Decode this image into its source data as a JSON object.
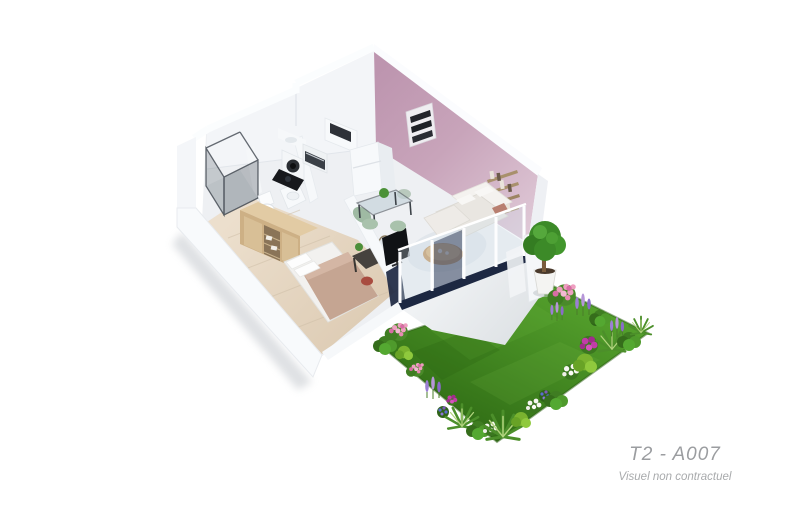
{
  "caption": {
    "unit_label": "T2 - A007",
    "disclaimer": "Visuel non contractuel"
  },
  "palette": {
    "pink_wall": "#c8a4ba",
    "pink_wall_dark": "#bd95af",
    "pink_wall_light": "#e0cad8",
    "wall": "#f7f9fb",
    "wall_shade": "#e9edf1",
    "floor": "#eef0f3",
    "floor_wood": "#e6dbc8",
    "grass_dark": "#2e6a14",
    "grass_light": "#54a02c",
    "terrace": "#eef0f2",
    "window_navy": "#1d2842",
    "wood_furniture": "#cdb085",
    "bed_blanket": "#c5a592",
    "sofa": "#ece9e4",
    "accent_cushion": "#b87f70",
    "chair_green": "#a9c2ac",
    "desk": "#46423e",
    "stool_red": "#a84c40",
    "coffee_table": "#c59a68",
    "foliage": "#3c8a28",
    "flower_pink": "#ee9fc0",
    "flower_magenta": "#c13da8",
    "flower_lavender": "#9c7fd4",
    "flower_white": "#f7f7f2",
    "caption": "#9b9da0",
    "caption_light": "#a8aaac"
  },
  "scene": {
    "type": "isometric 3D floor plan render",
    "rooms": [
      "bathroom",
      "kitchen",
      "living-room",
      "bedroom",
      "terrace",
      "garden"
    ],
    "objects": [
      "shower",
      "toilet",
      "washing-machine",
      "oven",
      "cooktop",
      "fridge",
      "wardrobe",
      "double-bed",
      "desk",
      "mirror",
      "stool",
      "tv",
      "dining-table",
      "dining-chairs",
      "sofa",
      "coffee-table",
      "rug",
      "wall-shelves",
      "glass-balustrade",
      "potted-tree",
      "flower-beds",
      "lawn"
    ]
  }
}
